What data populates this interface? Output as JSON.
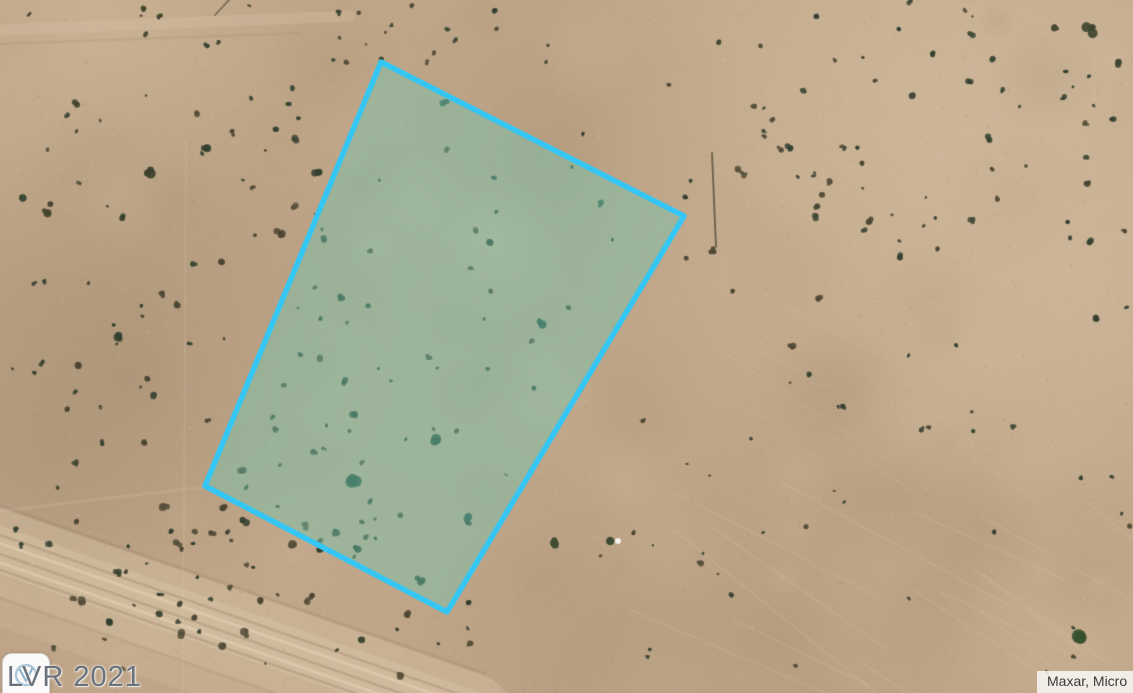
{
  "window": {
    "width_px": 1133,
    "height_px": 693
  },
  "map": {
    "view": "satellite-aerial-desert-land",
    "parcel": {
      "vertices": "381,62 684,216 447,612 205,486",
      "outline_color": "#35c6f4",
      "outline_width": 5.5,
      "fill_color": "rgba(110,200,178,0.42)"
    },
    "terrain": {
      "sand_base": "#c0a689",
      "sand_light": "#d8c3a6",
      "sand_bright": "#e8d6b8",
      "sand_dark": "#a08a6e",
      "sand_deep": "#8d775d",
      "shrub_colors": [
        "#4a4533",
        "#3e4836",
        "#564f3a",
        "#32402f"
      ],
      "pole_color": "#5a513d"
    }
  },
  "watermark": {
    "text": "LVR 2021"
  },
  "logo_badge": {
    "icon": "lvr-realtors-logo"
  },
  "attribution": {
    "text": "Maxar, Micro"
  }
}
